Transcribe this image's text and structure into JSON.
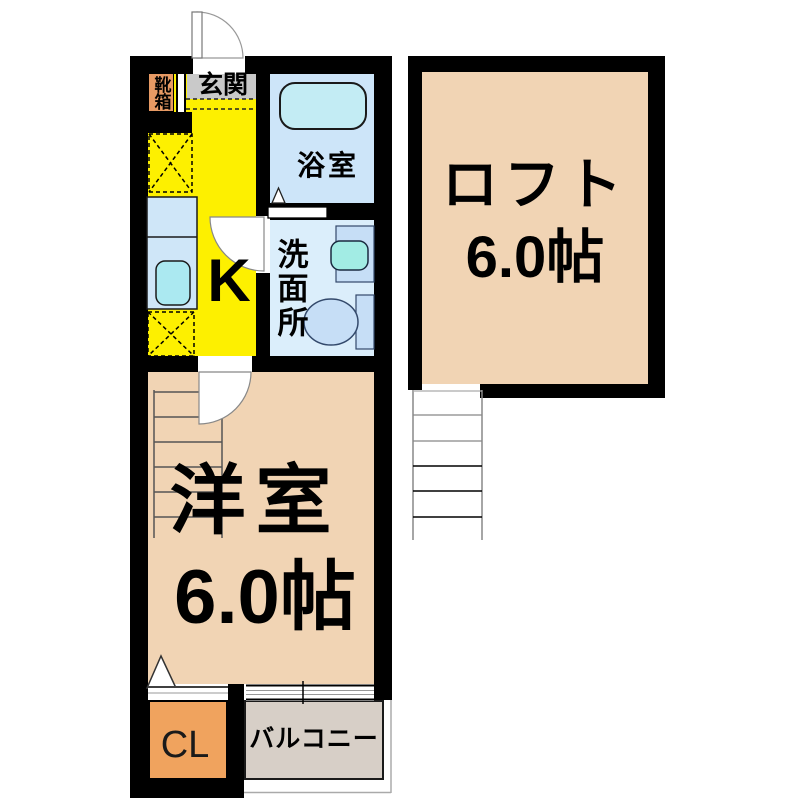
{
  "floorplan": {
    "type": "japanese-apartment-floor-plan",
    "rooms": {
      "shoebox": {
        "label": "靴箱",
        "color": "#e79a64"
      },
      "genkan": {
        "label": "玄関",
        "color": "#c9c9c9"
      },
      "kitchen": {
        "label": "K",
        "color": "#fdf000"
      },
      "bath": {
        "label": "浴室",
        "color": "#cde5f9"
      },
      "washroom": {
        "label": "洗面所",
        "color": "#dbeefb"
      },
      "western_room": {
        "label": "洋室",
        "size": "6.0帖",
        "color": "#f1d4b4"
      },
      "loft": {
        "label": "ロフト",
        "size": "6.0帖",
        "color": "#f1d4b4"
      },
      "closet": {
        "label": "CL",
        "color": "#f0a35e"
      },
      "balcony": {
        "label": "バルコニー",
        "color": "#d7cfc7"
      }
    },
    "fixtures": [
      "bathtub",
      "kitchen-sink",
      "wash-basin",
      "toilet",
      "ladder-to-loft",
      "staircase",
      "entrance-door",
      "room-doors",
      "window",
      "refrigerator-space",
      "appliance-space"
    ],
    "wall_color": "#000000"
  }
}
